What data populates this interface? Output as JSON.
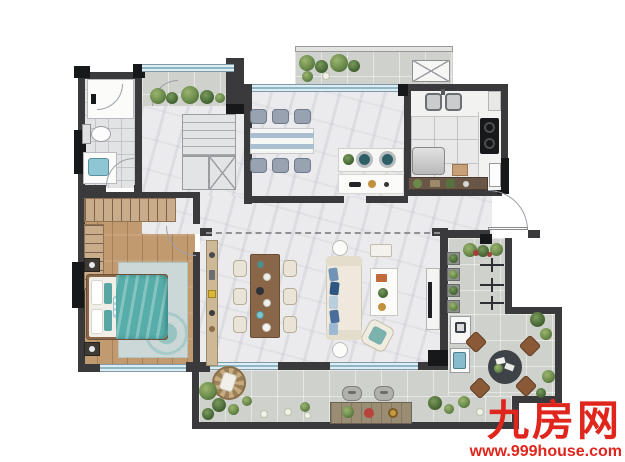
{
  "title": "residential-floor-plan",
  "watermark": {
    "brand": "九房网",
    "site": "www.999house.com",
    "color": "#e0251c"
  },
  "palette": {
    "wall": "#3a3a3c",
    "structural_black": "#17181a",
    "marble_floor": "#ebebee",
    "wood_floor": "#c29a6f",
    "bathroom_tile": "#e2e3e5",
    "kitchen_tile": "#e9e9ea",
    "terrace_paving": "#cfd2cc",
    "window_glass": "#8fb6c4",
    "bed_blanket_teal": "#57ada9",
    "gray_chair": "#98a2b1",
    "cream_chair": "#e9e4d5",
    "sofa_cream": "#eee9dc",
    "pillow_blue": "#2f5680",
    "plant_green": "#6a8a4b",
    "outdoor_chair_brown": "#8a5a38",
    "cabinet_brown": "#6a5646"
  },
  "rooms": [
    {
      "id": "bathroom"
    },
    {
      "id": "master-bedroom"
    },
    {
      "id": "walk-in-closet"
    },
    {
      "id": "staircase"
    },
    {
      "id": "hallway"
    },
    {
      "id": "north-balcony"
    },
    {
      "id": "multifunction-dining-room"
    },
    {
      "id": "kitchen"
    },
    {
      "id": "service-balcony"
    },
    {
      "id": "entry"
    },
    {
      "id": "living-dining-room"
    },
    {
      "id": "wraparound-terrace"
    }
  ],
  "furniture": [
    "shower",
    "toilet",
    "vanity-sink",
    "wardrobe-hangers",
    "double-bed",
    "nightstands",
    "area-rug",
    "u-shaped-stairs",
    "table-with-six-gray-chairs",
    "island-counter-two-stools",
    "double-kitchen-sink",
    "gas-stove",
    "refrigerator",
    "storage-shelf",
    "wood-dining-table-six-cream-chairs",
    "sideboard",
    "sofa-with-blue-pillows",
    "coffee-table",
    "armchair",
    "round-side-tables",
    "tv-console",
    "washing-machine",
    "outdoor-sink",
    "round-outdoor-table-four-chairs",
    "drying-racks",
    "planter-boxes",
    "bar-table-two-stools",
    "rattan-egg-chair",
    "ac-platform",
    "entry-door-swing"
  ]
}
